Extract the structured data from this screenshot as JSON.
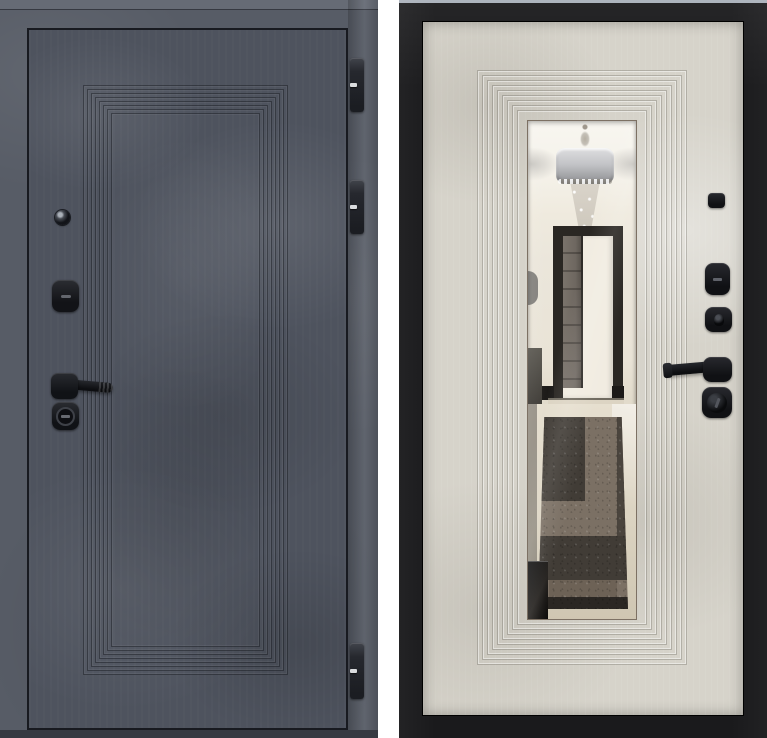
{
  "scene": {
    "subject": "Steel entry door shown from both sides",
    "panels": [
      {
        "name": "exterior-side",
        "finish": "dark graphite concrete with stepped panel molding",
        "hardware": [
          "peephole",
          "cylinder-cover",
          "lever-handle",
          "lock-cylinder",
          "hinge",
          "hinge",
          "hinge"
        ]
      },
      {
        "name": "interior-side",
        "finish": "light beige concrete with stepped molding and full-length mirror",
        "hardware": [
          "doorbell-button",
          "cylinder-cover",
          "keyhole",
          "lever-handle",
          "lock-cylinder"
        ]
      }
    ],
    "mirror_reflection": [
      "ceiling-cove-lighting",
      "drum-chandelier-with-crystals",
      "open-interior-doorway",
      "geometric-hallway-rug",
      "glossy-dark-floor"
    ]
  },
  "colors": {
    "page_bg": "#ffffff",
    "ext_frame": "#575c66",
    "ext_frame_top": "#666b75",
    "ext_leaf": "#4e535e",
    "ext_edge_line": "#181a20",
    "ext_threshold": "#363a42",
    "hardware": "#17181b",
    "hardware_hi": "#3c3e45",
    "hinge": "#26282e",
    "hinge_hi": "#41444b",
    "hinge_pin": "#d9dbdd",
    "int_frame": "#1a1a1c",
    "int_top_strip": "#a9b0ba",
    "int_leaf": "#d6d3ca",
    "mirror_ceiling": "#f8f6f0",
    "mirror_wall": "#ebe6db",
    "mirror_floor": "#e0d9ca",
    "doorway_casing": "#2a2723",
    "doorway_door": "#6e6760",
    "doorway_opening": "#f1ece1",
    "rug_light": "#7b7064",
    "rug_dark": "#413c36",
    "rug_deep": "#2b2723",
    "furniture_black": "#121110",
    "shade_light": "#dedee0",
    "shade_dark": "#9b9c9f"
  }
}
